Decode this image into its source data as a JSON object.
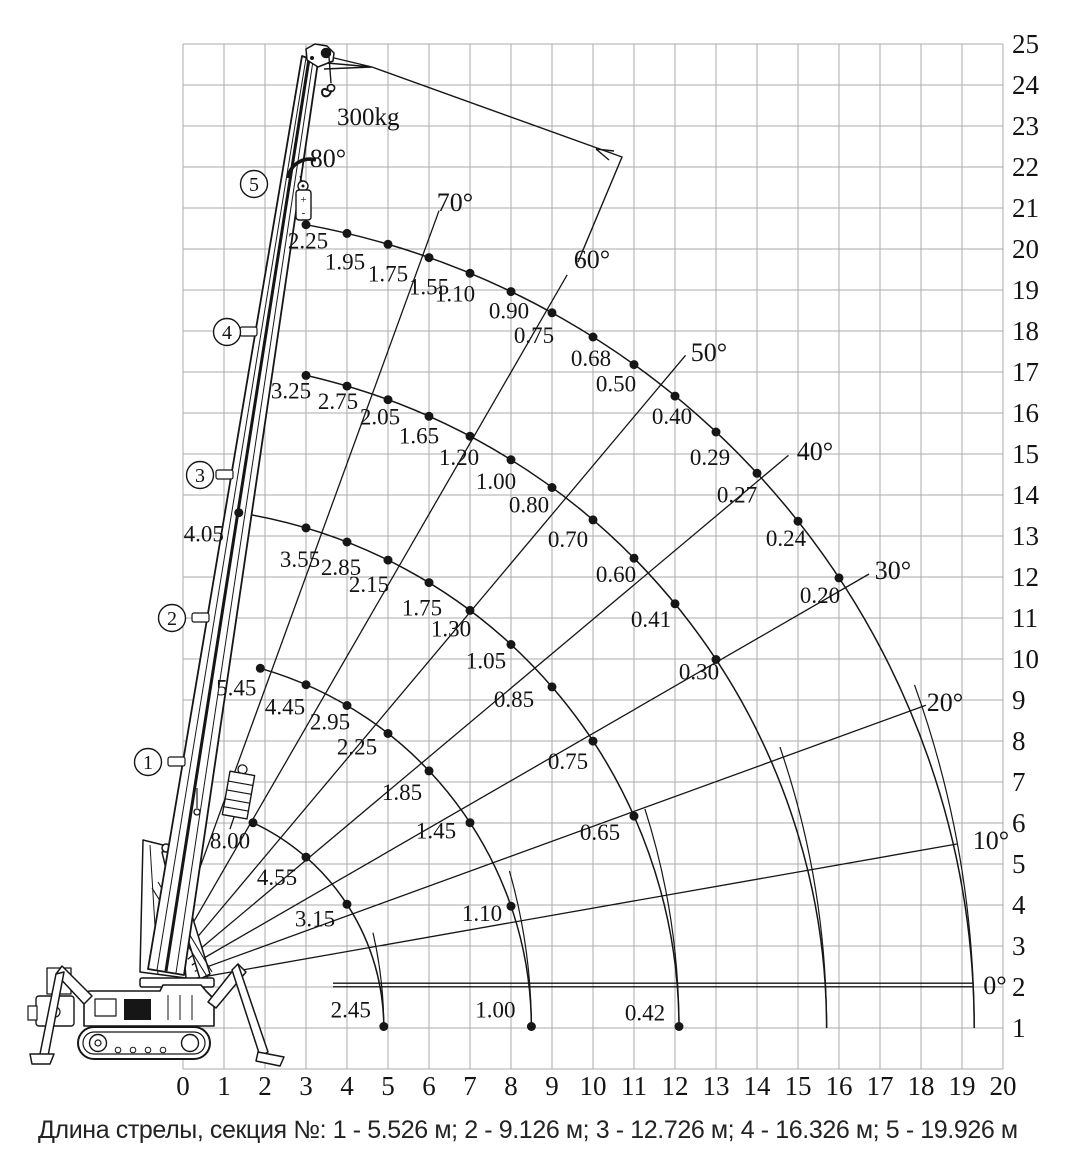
{
  "caption": "Длина стрелы, секция №: 1 - 5.526 м; 2 - 9.126 м; 3 - 12.726 м; 4 - 16.326 м; 5 - 19.926 м",
  "hook_load_label": "300kg",
  "chart_data": {
    "type": "crane-load-chart",
    "title": "Lifting capacity diagram (spider crane)",
    "x_axis": {
      "units": "m",
      "ticks": [
        0,
        1,
        2,
        3,
        4,
        5,
        6,
        7,
        8,
        9,
        10,
        11,
        12,
        13,
        14,
        15,
        16,
        17,
        18,
        19,
        20
      ]
    },
    "y_axis": {
      "units": "m",
      "ticks": [
        1,
        2,
        3,
        4,
        5,
        6,
        7,
        8,
        9,
        10,
        11,
        12,
        13,
        14,
        15,
        16,
        17,
        18,
        19,
        20,
        21,
        22,
        23,
        24,
        25
      ]
    },
    "grid": true,
    "angle_labels": [
      "0°",
      "10°",
      "20°",
      "30°",
      "40°",
      "50°",
      "60°",
      "70°",
      "80°"
    ],
    "max_tip_load": "300kg",
    "sections": [
      {
        "section": 1,
        "boom_length_m": 5.526,
        "capacities": [
          {
            "radius_m": 1.7,
            "load_t": "8.00",
            "at_start": true
          },
          {
            "radius_m": 3,
            "load_t": "4.55"
          },
          {
            "radius_m": 4,
            "load_t": "3.15"
          }
        ],
        "end_load_t": "2.45"
      },
      {
        "section": 2,
        "boom_length_m": 9.126,
        "capacities": [
          {
            "radius_m": 1.9,
            "load_t": "5.45",
            "at_start": true
          },
          {
            "radius_m": 3,
            "load_t": "4.45"
          },
          {
            "radius_m": 4,
            "load_t": "2.95"
          },
          {
            "radius_m": 5,
            "load_t": "2.25"
          },
          {
            "radius_m": 6,
            "load_t": "1.85"
          },
          {
            "radius_m": 7,
            "load_t": "1.45"
          },
          {
            "radius_m": 8,
            "load_t": "1.10"
          }
        ],
        "end_load_t": "1.00"
      },
      {
        "section": 3,
        "boom_length_m": 12.726,
        "capacities": [
          {
            "radius_m": 1.4,
            "load_t": "4.05",
            "at_start": true
          },
          {
            "radius_m": 3,
            "load_t": "3.55"
          },
          {
            "radius_m": 4,
            "load_t": "2.85"
          },
          {
            "radius_m": 5,
            "load_t": "2.15"
          },
          {
            "radius_m": 6,
            "load_t": "1.75"
          },
          {
            "radius_m": 7,
            "load_t": "1.30"
          },
          {
            "radius_m": 8,
            "load_t": "1.05"
          },
          {
            "radius_m": 9,
            "load_t": "0.85"
          },
          {
            "radius_m": 10,
            "load_t": "0.75"
          },
          {
            "radius_m": 11,
            "load_t": "0.65"
          }
        ],
        "end_load_t": "0.42"
      },
      {
        "section": 4,
        "boom_length_m": 16.326,
        "capacities": [
          {
            "radius_m": 3,
            "load_t": "3.25"
          },
          {
            "radius_m": 4,
            "load_t": "2.75"
          },
          {
            "radius_m": 5,
            "load_t": "2.05"
          },
          {
            "radius_m": 6,
            "load_t": "1.65"
          },
          {
            "radius_m": 7,
            "load_t": "1.20"
          },
          {
            "radius_m": 8,
            "load_t": "1.00"
          },
          {
            "radius_m": 9,
            "load_t": "0.80"
          },
          {
            "radius_m": 10,
            "load_t": "0.70"
          },
          {
            "radius_m": 11,
            "load_t": "0.60"
          },
          {
            "radius_m": 12,
            "load_t": "0.41"
          },
          {
            "radius_m": 13,
            "load_t": "0.30"
          }
        ],
        "end_load_t": null
      },
      {
        "section": 5,
        "boom_length_m": 19.926,
        "capacities": [
          {
            "radius_m": 3,
            "load_t": "2.25"
          },
          {
            "radius_m": 4,
            "load_t": "1.95"
          },
          {
            "radius_m": 5,
            "load_t": "1.75"
          },
          {
            "radius_m": 6,
            "load_t": "1.55"
          },
          {
            "radius_m": 7,
            "load_t": "1.10"
          },
          {
            "radius_m": 8,
            "load_t": "0.90"
          },
          {
            "radius_m": 9,
            "load_t": "0.75"
          },
          {
            "radius_m": 10,
            "load_t": "0.68"
          },
          {
            "radius_m": 11,
            "load_t": "0.50"
          },
          {
            "radius_m": 12,
            "load_t": "0.40"
          },
          {
            "radius_m": 13,
            "load_t": "0.29"
          },
          {
            "radius_m": 14,
            "load_t": "0.27"
          },
          {
            "radius_m": 15,
            "load_t": "0.24"
          },
          {
            "radius_m": 16,
            "load_t": "0.20"
          }
        ],
        "end_load_t": null
      }
    ]
  }
}
